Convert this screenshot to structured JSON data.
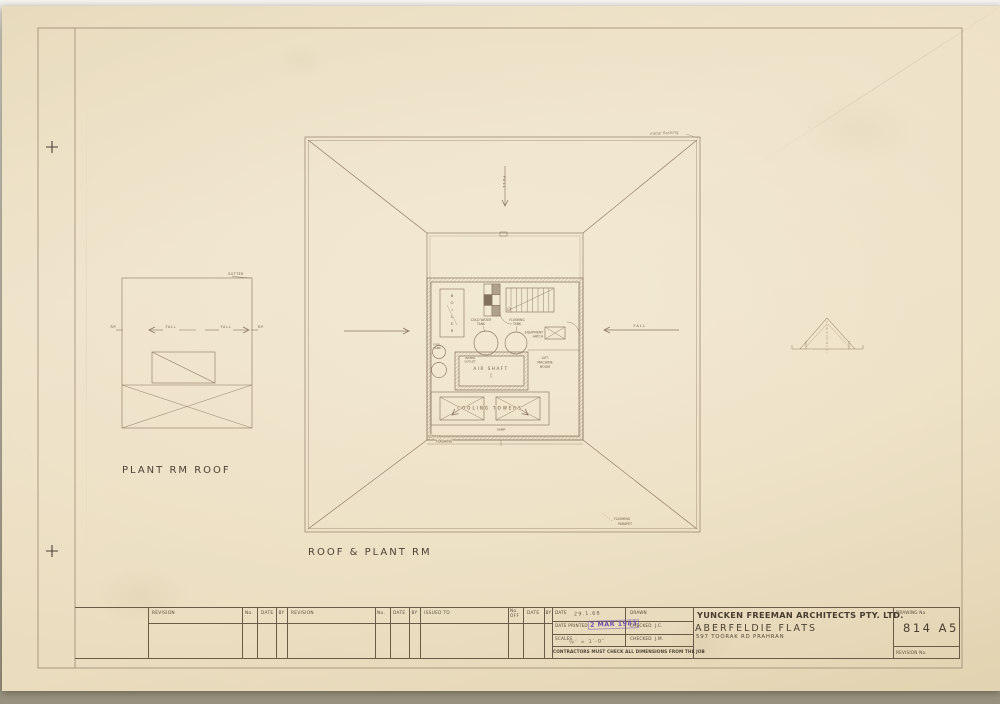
{
  "colors": {
    "paper": "#ecdfc3",
    "line": "#8a7760",
    "ink": "#6f5e4a",
    "caption": "#4e4133",
    "stamp": "#6d4fa5"
  },
  "captions": {
    "small_plan": "PLANT RM ROOF",
    "main_plan": "ROOF & PLANT RM"
  },
  "small_plan": {
    "gutter": "GUTTER",
    "rp_left": "R.P.",
    "rp_right": "R.P.",
    "fall_left": "FALL",
    "fall_right": "FALL"
  },
  "main_plan": {
    "fall_top": "FALL",
    "fall_right": "FALL",
    "flashing_note": "metal flashing",
    "boiler": [
      "B",
      "O",
      "I",
      "L",
      "E",
      "R"
    ],
    "fuel_tank": [
      "FUEL",
      "TANK"
    ],
    "cold_water_tank": [
      "COLD WATER",
      "TANK"
    ],
    "flushing_tank": [
      "FLUSHING",
      "TANK"
    ],
    "equipment_hatch": [
      "EQUIPMENT",
      "HATCH"
    ],
    "lift_machine_room": [
      "LIFT",
      "MACHINE",
      "ROOM"
    ],
    "water_outlet": [
      "WATER",
      "OUTLET"
    ],
    "air_shaft": "AIR SHAFT",
    "cooling_towers": "COOLING TOWERS",
    "sump": "SUMP",
    "gutter_flashing": [
      "GUTTER",
      "FLASHING"
    ],
    "flashing_parapet": [
      "FLASHING",
      "PARAPET"
    ]
  },
  "title_block": {
    "headers": {
      "revision": "REVISION",
      "no": "No.",
      "date": "DATE",
      "by": "BY",
      "issued_to": "ISSUED TO",
      "no_off_1": "No.",
      "no_off_2": "OFF"
    },
    "date_label": "DATE",
    "date_value": "29.1.68",
    "date_printed_label": "DATE PRINTED",
    "stamp": "2 MAR 1983",
    "scales_label": "SCALES",
    "scales_value": "⅛″ = 1′-0″",
    "drawn_label": "DRAWN",
    "checked1_label": "CHECKED",
    "checked1_value": "J.C.",
    "checked2_label": "CHECKED",
    "checked2_value": "J.M.",
    "note": "CONTRACTORS MUST CHECK ALL DIMENSIONS FROM THE JOB",
    "firm": "YUNCKEN FREEMAN ARCHITECTS PTY. LTD.",
    "project": "ABERFELDIE FLATS",
    "address": "597 TOORAK RD PRAHRAN",
    "drawing_no_label": "DRAWING No.",
    "drawing_no": "814 A5",
    "revision_no_label": "REVISION No."
  }
}
